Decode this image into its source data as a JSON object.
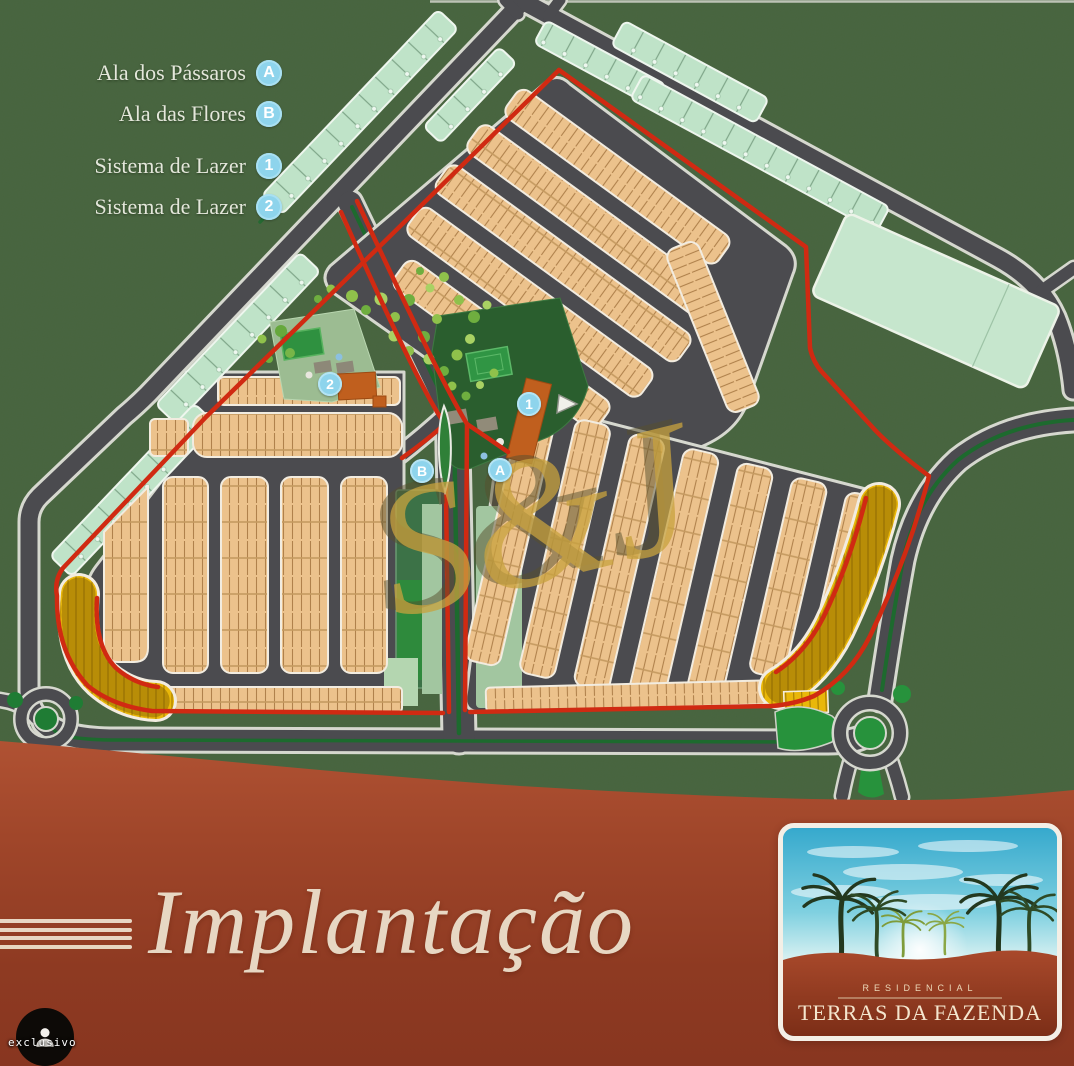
{
  "legend": {
    "items": [
      {
        "label": "Ala dos Pássaros",
        "badge": "A"
      },
      {
        "label": "Ala das Flores",
        "badge": "B"
      },
      {
        "label": "Sistema de Lazer",
        "badge": "1"
      },
      {
        "label": "Sistema de Lazer",
        "badge": "2"
      }
    ]
  },
  "map": {
    "watermark": "S&J",
    "markers": [
      {
        "label": "A"
      },
      {
        "label": "B"
      },
      {
        "label": "1"
      },
      {
        "label": "2"
      }
    ]
  },
  "banner": {
    "title": "Implantação"
  },
  "logo": {
    "tagline": "RESIDENCIAL",
    "name": "TERRAS DA FAZENDA"
  },
  "overlay": {
    "corner_label": "exclusivo"
  },
  "colors": {
    "background": "#46643e",
    "road": "#4b4b4f",
    "boundary_red": "#d02a12",
    "lot_tan": "#ecc28c",
    "green_strip": "#bfe3c8",
    "yellow_lots": "#e9b70a",
    "badge_blue": "#8ed4ec",
    "banner_rust": "#9c4228",
    "cream": "#e7d7c3"
  }
}
